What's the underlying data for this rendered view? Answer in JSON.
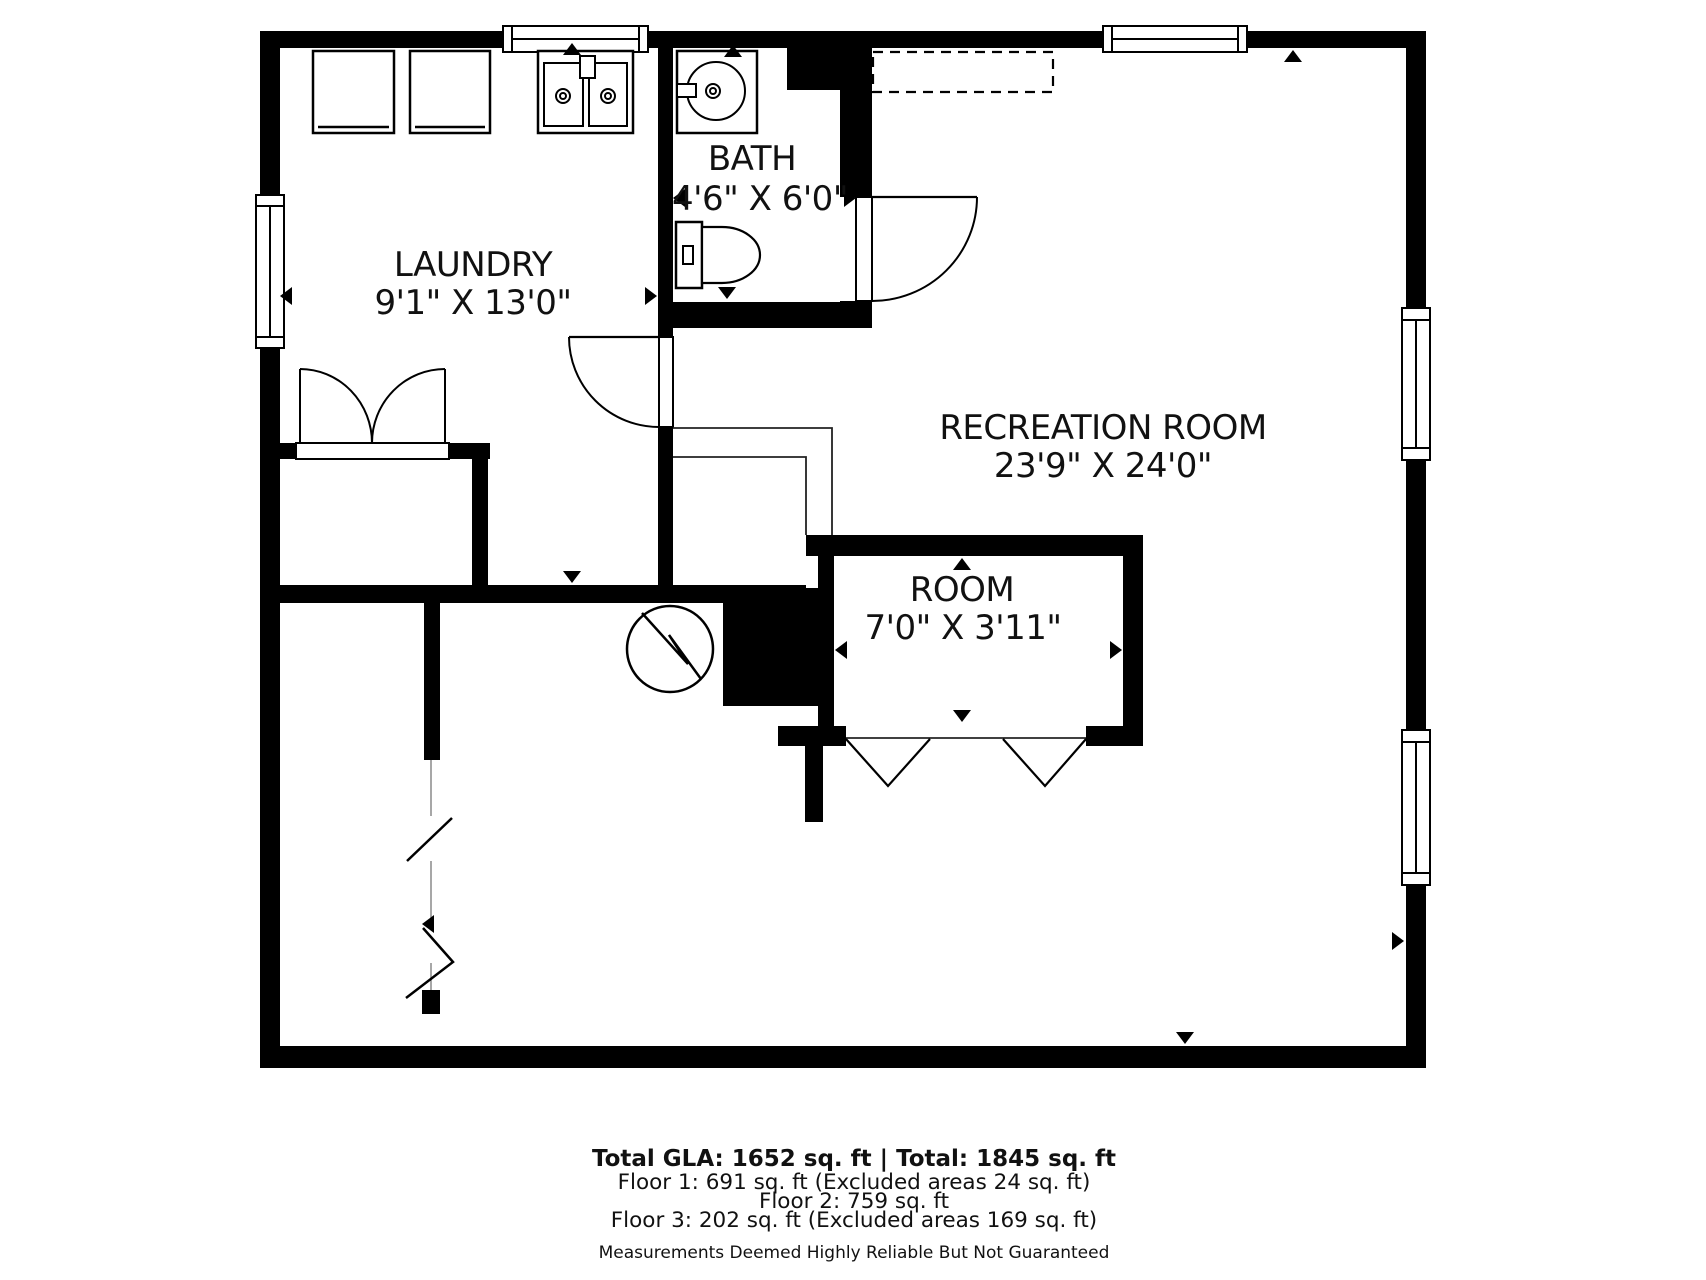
{
  "rooms": [
    {
      "id": "laundry",
      "name": "LAUNDRY",
      "dims": "9'1\" X 13'0\""
    },
    {
      "id": "bath",
      "name": "BATH",
      "dims": "4'6\" X 6'0\""
    },
    {
      "id": "recreation",
      "name": "RECREATION ROOM",
      "dims": "23'9\" X 24'0\""
    },
    {
      "id": "room",
      "name": "ROOM",
      "dims": "7'0\" X 3'11\""
    }
  ],
  "footer": {
    "summary": "Total GLA: 1652 sq. ft | Total: 1845 sq. ft",
    "floors": [
      "Floor 1: 691 sq. ft (Excluded areas 24 sq. ft)",
      "Floor 2: 759 sq. ft",
      "Floor 3: 202 sq. ft (Excluded areas 169 sq. ft)"
    ],
    "disclaimer": "Measurements Deemed Highly Reliable But Not Guaranteed"
  },
  "colors": {
    "wall": "#000000",
    "background": "#ffffff",
    "line": "#000000"
  },
  "fixtures": [
    "washer",
    "dryer",
    "laundry-sink",
    "bath-sink",
    "toilet",
    "utility-meter",
    "door-swing",
    "closet-double-doors",
    "bifold-doors",
    "window",
    "stair-break"
  ]
}
